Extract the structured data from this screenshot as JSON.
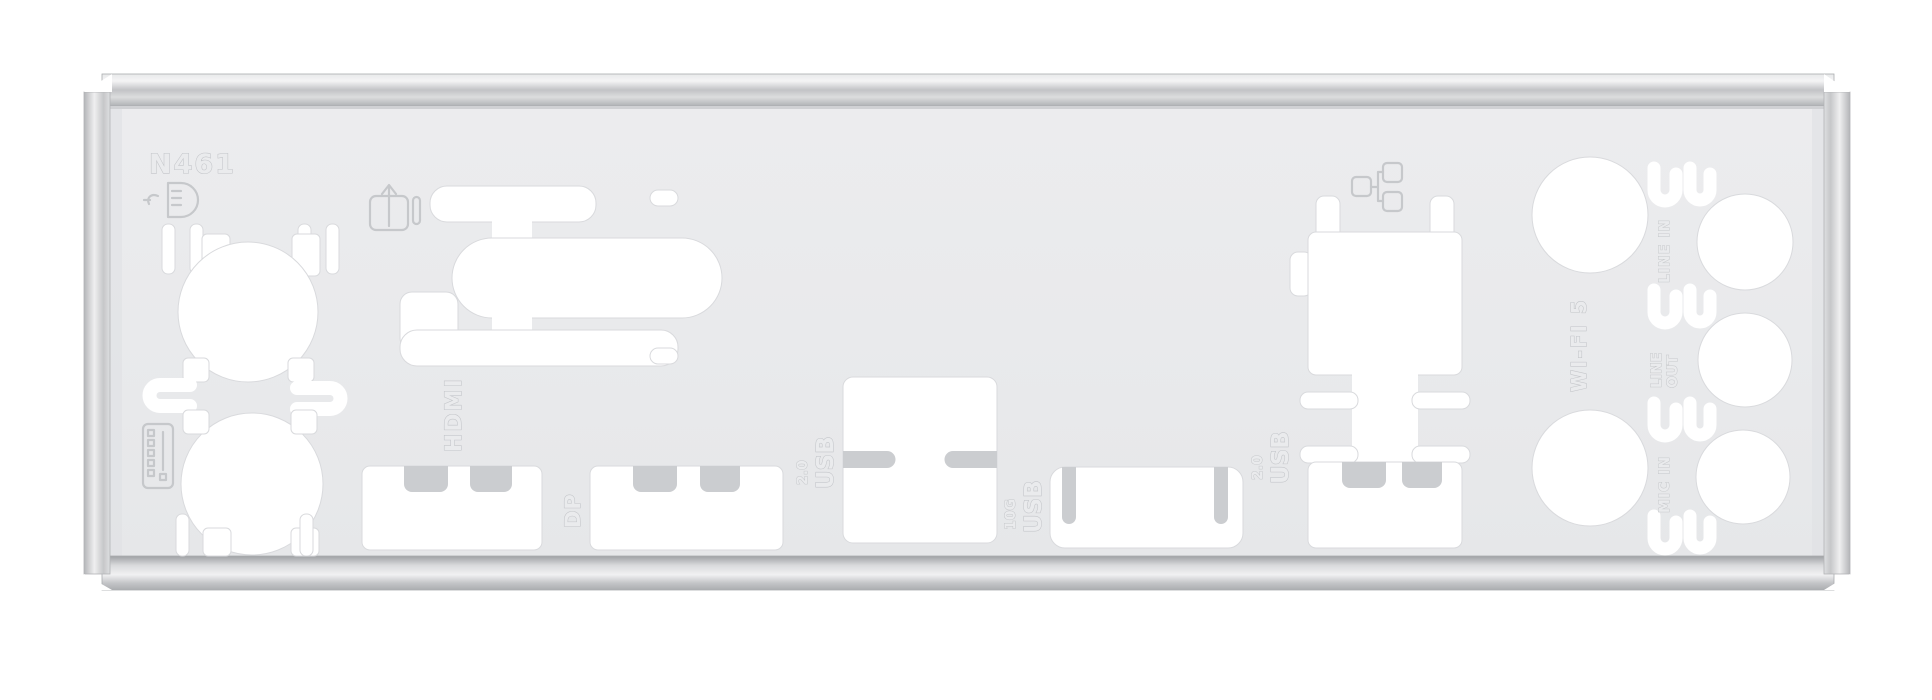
{
  "scene": {
    "description": "Motherboard rear I/O shield backplate, stamped metal, photographed on a white background"
  },
  "colors": {
    "background": "#ffffff",
    "panel": "#e9eaec",
    "cutout": "#ffffff",
    "finger_tab": "#cbcdd0",
    "emboss_stroke": "#c3c5c9",
    "metal_light": "#f3f3f4",
    "metal_mid": "#c6c7ca",
    "metal_dark": "#a8aaad"
  },
  "labels": {
    "model_code": "N461",
    "hdmi": "HDMI",
    "dp": "DP",
    "usb2_left": {
      "speed": "2.0",
      "name": "USB"
    },
    "usb10g": {
      "speed": "10G",
      "name": "USB"
    },
    "usb2_right": {
      "speed": "2.0",
      "name": "USB"
    },
    "wifi": "WI-FI 5",
    "line_in": "LINE IN",
    "line_out": {
      "l1": "LINE",
      "l2": "OUT"
    },
    "mic_in": "MIC IN"
  },
  "icons": {
    "ps2": "ps2-connector-icon",
    "display": "monitor-arrow-icon",
    "keyboard": "keyboard-icon",
    "lan": "lan-icon"
  }
}
